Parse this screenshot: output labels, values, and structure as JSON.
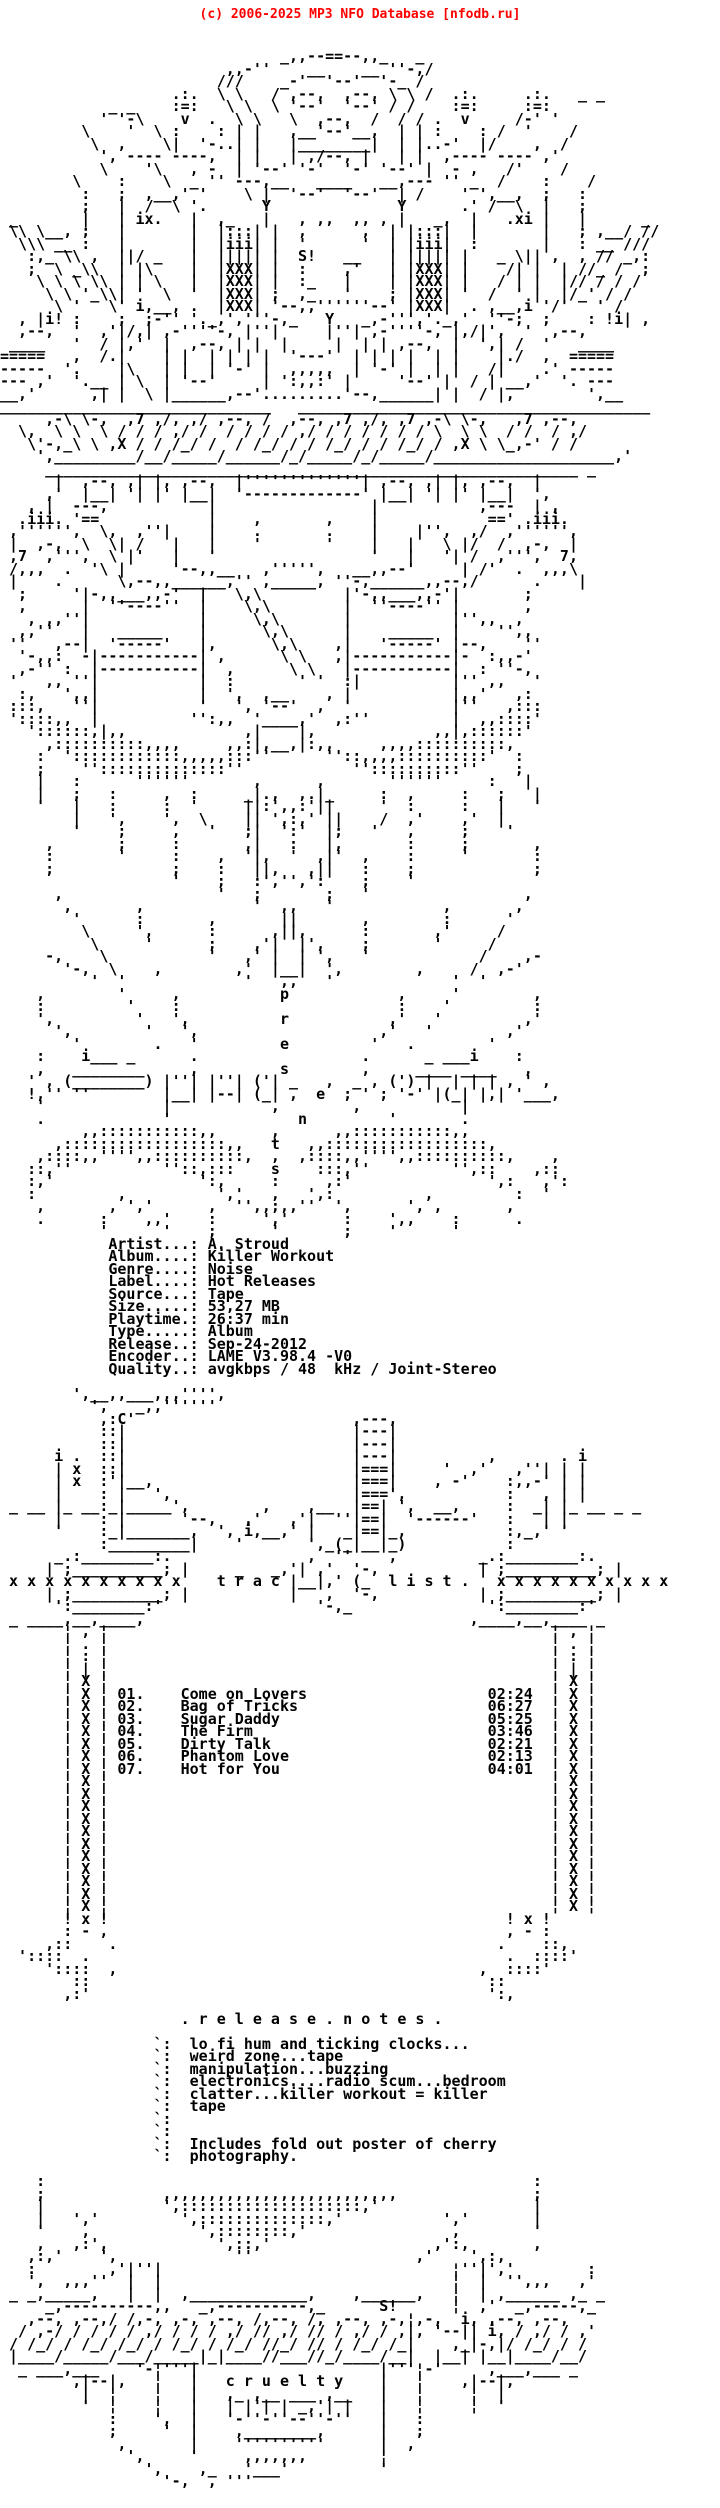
{
  "page": {
    "copyright": "(c) 2006-2025 MP3 NFO Database [nfodb.ru]"
  },
  "colors": {
    "header_text": "#ff0000",
    "body_text": "#000000",
    "background": "#ffffff"
  },
  "texts": {
    "roman_left": "ix.",
    "roman_right": ".xi",
    "shout_mark": "S!",
    "presents_vertical": "presents:",
    "proudly_word": "proudly",
    "x_row": "x x x x x x x x x x",
    "tracklist_header": "t r a c   l i s t .",
    "release_notes_header": ". r e l e a s e . n o t e s .",
    "cruelty_word": "c r u e l t y"
  },
  "release_info": {
    "fields": [
      {
        "label": "Artist...:",
        "value": "A. Stroud"
      },
      {
        "label": "Album....:",
        "value": "Killer Workout"
      },
      {
        "label": "Genre....:",
        "value": "Noise"
      },
      {
        "label": "Label....:",
        "value": "Hot Releases"
      },
      {
        "label": "Source...:",
        "value": "Tape"
      },
      {
        "label": "Size.....:",
        "value": "53,27 MB"
      },
      {
        "label": "Playtime.:",
        "value": "26:37 min"
      },
      {
        "label": "Type.....:",
        "value": "Album"
      },
      {
        "label": "Release..:",
        "value": "Sep-24-2012"
      },
      {
        "label": "Encoder..:",
        "value": "LAME V3.98.4 -V0"
      },
      {
        "label": "Quality..:",
        "value": "avgkbps / 48  kHz / Joint-Stereo"
      }
    ]
  },
  "tracklist": {
    "title": "t r a c   l i s t .",
    "tracks": [
      {
        "num": "01.",
        "title": "Come on Lovers",
        "time": "02:24"
      },
      {
        "num": "02.",
        "title": "Bag of Tricks",
        "time": "06:27"
      },
      {
        "num": "03.",
        "title": "Sugar Daddy",
        "time": "05:25"
      },
      {
        "num": "04.",
        "title": "The Firm",
        "time": "03:46"
      },
      {
        "num": "05.",
        "title": "Dirty Talk",
        "time": "02:21"
      },
      {
        "num": "06.",
        "title": "Phantom Love",
        "time": "02:13"
      },
      {
        "num": "07.",
        "title": "Hot for You",
        "time": "04:01"
      }
    ]
  },
  "release_notes": {
    "title": ". r e l e a s e . n o t e s .",
    "lines": [
      "lo fi hum and ticking clocks...",
      "weird zone...tape",
      "manipulation...buzzing",
      "electronics....radio scum...bedroom",
      "clatter...killer workout = killer",
      "tape",
      "",
      "",
      "Includes fold out poster of cherry",
      "photography."
    ]
  },
  "ascii_art": {
    "top": [
      "                               _,,--==--,,_   _",
      "                         ,,-''    __    __ ''-,/",
      "                        ///    _-'  '--'  '-_ /",
      "                   .:.  \\ \\   / ,--,  ,--, \\ \\ /  .:.     .:.   _ _",
      "            _ _    :=:   \\ \\  \\ '--'  '--' / /    :=:     :=:",
      "           ' '-\\    v  .  \\ \\   \\  ,--,  /  / / .  v     /-' '",
      "         \\    '  \\ :    : | |   ,__'--'__,  | | :    : /  '    /",
      "          \\  ,    \\|  '-..| |   |________|  | |..-'  |/    ,  /",
      "           ', ---- ----,  | |   | ,/--, |   | |  ,---- ---- ,'",
      "           \\    '\\   , -  | '--' '-'  '-' '--' |  - ,   /'    /",
      "        \\    :    \\  _ '' ---,__   ____   __,--- '' _  /    :    /",
      "         :   ;  ,__,' '    \\ |  '--'  '--'  | /    ' ',__,  ;   :",
      "         ;   |  /  \\ '.      Y              Y      .' /  \\  |   ;",
      " _       |   | ix.   |  ,_   |   , ,,  ,, , |   _,  |   .xi |   |      _",
      " \\\\ \\__, ;   |       |  |:::| |  ,      ,  | |:::|  |       |   ; ,__/ //",
      "  \\\\\\ __ :   |       |  |iii| |  '      '  | |iii|  :       |   : __ ///",
      "   :,_ \\\\ ,  ||/ _   |  ||||| |  S!   __   | ||||| |   _ \\|| ,  , // _,:",
      "   ;  \\ _\\\\  | |\\    |  |XXX| |  :    ,'   | |XXX| |    /| |  | //_ /  ;",
      "    \\ \\ \\ \\\\ | | \\   |  |XXX| |  :_   |    | |XXX| |   / | |  |// / / /",
      "     \\ \\ '_\\\\| '  \\  '  |XXX| ;  ,_   '    ; |XXX| '  /  ' |  |/_' / /",
      "      \\ '   \\' i,__, .  |XXX| '--,,''''''--' |XXX|  . ,__,i '/'   ' /",
      "  , |i! :    ;  ;-'' '._,','''-,_   Y   _,-''','._,'  ''-;  ;    : !i| ,",
      "  ,--,  '  ,'|/,| ,-''''-, |''|     |''| ,-''''-, |,/|',  '  ,--,",
      " ____   '  / |,'  |  ,--, | |  |     |  | | ,--,  |  ',| /  '   ____",
      "=====   ,  /.|    | |  | | | |  '---'  | | | |  | |    |./  ,  =====",
      "-----  '.    |\\   | |  | '-' |  ,,,,,  | '-' |  | |   /|    .' -----",
      "--- ,'  '.__ | \\  | '--'     | ':,,:' |     '--' |  / | __,'  '. ---",
      "__,'      ,| |  \\ |______,--'.........'--,______| |  / |,        ',__",
      "______________________________   _______________________________________",
      "     ,-\\ \\-,  ,7 ,/, ,/ ,--, /  ,--, ,7 ,/, ,7 ,-\\ \\-,   ,7 ,--,",
      "  \\,  \\ \\  \\ / / / ,/ /  / / / / ,/ / / / / / / \\  \\ \\  / /  / ,/",
      "   \\'-,_\\ \\ ,X / / /_/ /  / /_/ / / /_/ / / /_/ / ,X \\ \\_,-' / /",
      "    ',_________/__/_____/______/_/_____/_/_____/____________________,'",
      "     ___________________________________________________________ _",
      "      |  ,--, ,| |, ,--,  |'''''''''''''| ,--, ,| |, ,--,  |",
      "     ,'  |__| '| |' |__|  '-------------' |__| '| |' |__|  ',",
      "   , |  ---,           |                 |           ,---  | ,",
      "  .iii. '==            |    ,       ,    |            ==' .iii.",
      " ,'''''',  \\,  ,''|    |    .       .    |    |'',  ,/  ,'''''',",
      " |  ,-,  \\  \\| /   |   |    '       '    |   |   \\ |/  /  ,-,  |",
      " ,7  ,''',  \\ |'   |   '                 '   |   '| /  ,''',  7,",
      " /,,,  .  '\\ |     '--,,__   ,''''',   __,,--'     | /'  .  ,,,\\",
      " |    .      \\,--,,______,'' ,_____, ''-,______,,--,/      .    |",
      "  ;     '|-,,___,,-'  |   \\,\\         |'-,,___,,-'|       ;",
      "  ,      |  ''----''  |    \\,\\        |  ''----'' |       ,",
      "   , ,,''|            |     \\,\\       |           |'',,  ,",
      "  ,,''   |   _____    |      \\,\\      |    _____  |    '',,",
      " ''   ,--|  '-----'   |,      \\,\\    ,|   '-----' |--,    ''",
      "  '-,,:  -|-----------| ,      \\ \\   ,|-----------|-  :,,-'",
      "  ,-'' :  |-----------|  ,      \\ \\   |-----------|  : ''-,",
      " '   ,, ''|           |  :       ' '  :|          |'' ,,   '",
      "  :,   ',,|           |  ',  ,__    , |           |,,'   ,:",
      " :::,   ''|           '   ', '--'  ,  '           |''   ,:::",
      " '::::,,  |          '':,,  '____,'  ,:''         |  ,,::::'",
      "   '::::::,|,,             ,|    |,             ,,|,::::::'",
      "     ,::::::::::,,,,     ,,:|,__,|:,,     ,,,,::::::::::,",
      "    :  '::::::::::::,,,,,:::''      ''::,,,,::::::::::'  :",
      "    ;    ''::::::::::::::''            ''::::::::::''    ;",
      "    |   :      ''''''       ,      ,       ''''''     :   |",
      "    |   ;   :     ,  :     _|.,  ,.|_     :  ,     :   ;   |",
      "    '   |   :     :  '     ||:',,:'||     '  :     :   |   '",
      "        |   ',    ',  \\    || ',:,' ||    /  ,'    ,'  |",
      "        '    ;     ,   '   ;|  ':'  |;   '   ,     ;    '",
      "     ,       ;     :       ,|   :   |,       :     ;       ,",
      "     :       '     :    ,  '|,  '  ,|'  ,    :     '       :",
      "     ;             ;    :   ||,   ,||   :    ;             ;",
      "                   '    ;   :','',':    ;    '",
      "      ,                 '   ;       ;   '                 ,",
      "       ,       ,            '  ,,   '            ,       ,",
      "        '      :       ,       ||       ,        :      '",
      "         \\     ',      :      ,||,      :       ,'     /",
      "          \\     '      ;    ,'|  |',    ;       '     /",
      "     -,    \\           '   ,' |  | ',   '            /    ,-",
      "       '-,  \\    ,        ,'  |__|  ',        ,     /  ,-'",
      "          '  '             '   ,,   '             '  '",
      "    ,        '     ,           p            ,     '        ,",
      "    :         '    :                        :    '         :",
      "    ',         '   ',          r           ,'   '         ,'",
      "      ',        '   ',                    ,'   '        ,'",
      "        '        .   '         e         '   .        '",
      "    :    i___ _      .                  .      _ ___i    :",
      "    ,   ________     ,         s        ,     ____ ____   ,",
      "   ' , (________) |''| |''| ('| _   ,  _ , (') |  | | | , ' ,",
      "   !,'' ''        |__| |--| (_| ,  e  ; ' ; '-' |(_| |,| '___,",
      "    '             |           ,        ,           |",
      "    .             '              n         '       .",
      "         ,,:::::::::::,,      ,      ,,:::::::::::,,",
      "      ,::::::::::::::::::,,   t   ,,::::::::::::::::::,",
      "    ,::::,,'''',,::::::::::,  ,  ,::::,,'''',,::::::::::,    ,",
      "   ::,''          ''::,:::    s    :::,''         '',::    ,::",
      "   :,'                ':,     :     ,:'               ',:   ,':",
      "   :         ,          ','   ,   ',:          ,         :  '",
      "    ,       , ','      ,  '',,;,,''  ',      ', ,       ,",
      "    .      :    ,,'    :     ','      :    ',,    :      .",
      "           '      '    ;      '       ;    '      '"
    ],
    "middle": [
      "        ',__,,___,,,'''',",
      "          ',   _,,''''''",
      "           ,:C'                        ,---,",
      "           ::|                         |---|",
      "           ::|                         |---|",
      "      i .  ::|                         |---|          ,       . i",
      "      | x  ::|                         |===|     '  ,'   ,''| | |",
      "      | x  :'|__,                      |===|    , -'    :,,-' | |",
      "      |    : |   ',                    |===',           :   , | |",
      " _ __ |_ __:_|_____',        ,    ,__  |==| ',  __,     :  _| |_ __ _ _",
      "      |    : |      '--,   ,'   ,'|  ''|==|  '------'   :   | |",
      "      '    :_|_______,  ', i,__,' |   _|==|_,           :,_,' '",
      "           :_________|    '       ',_(_|__|_)           :",
      "      _.:________:.               ,  ''    ,         _.:________:.",
      "     | ;__________; |     _   _,'| ,'  '-,           | ;__________; |",
      " x x x x x x x x x x    t r a c |__|,' (_  l i s t .   x x x x x x x x x x",
      "     | ;__________; |           |   ,  '-,           | ;__________; |",
      "      ':________:'                 '-,_               ':________:'",
      " _ ____,__,____,                                    ,____,__,____ _"
    ],
    "tail": [
      "       ! x !                                            ! x !",
      "       : - ,                                            , - :",
      "     ,::    .                                          .    ::,",
      "  '::::  .                                              .  ::::'",
      "     '::::  ,                                        ,  ::::'",
      "        ::                                            ::",
      "       ,:'                                            ':,"
    ],
    "lower": [
      "    :                                                      :",
      "    ;             ,,,,,,,,,,,,,,,,,,,,,,,,,,               ;",
      "    |             ',::::::::::::::::::::,'                 |",
      "    |   ','         ',::::::::::::::,'           ','       |",
      "    '    ,            ',::::::::,'                ,        '",
      "    ,   ,:',            ',::,'                  ,':,       ,",
      "   ,:,'    ',             ''                  ,'    ',:,"
    ],
    "bottom": [
      "   :        ,'|''|                                ¦''|','        :",
      "   ',  ,,,''  |  |                                ¦  |  '',,,   ,'",
      " _ _,_____,   |  |  ,_____________,    ,______,   ¦  | ,______ ,_ _",
      "     _,----------,,   _,----------,_      S!      ¦  ,'  _,-----,_",
      "   ,--, ,--,/ /,-, ,-, ,--, /,--, /, ,--, ,-,¦,-,  i, ,--, ,--,",
      "  / ,-/ / / / / ,/ / / / ,/ // ,/ // / ,/ / ,|, '--|| i, / ,/ / ,'",
      " / /_/ / /_/ /_/ / /_/ / /_/ //_/ // / /_/ /_|    ,_|-,|/ /_/ / /",
      " |____/_____/___/_____|_|____//___//_/____/__|  |__| |__|____/__/",
      "  _ ___,___    '-¦'''|                    |'''¦-'     ,___,___ _",
      "        ,|--|,   ¦   |   c r u e l t y    |   ¦    ,|--|,",
      "         |  ¦    ¦   |   ,_ ,__ ___ ,__   |   ¦     ¦  |",
      "         '  ¦    ¦   |   | |'| | _,'| |   |   ¦     ¦  '",
      "            :    ',  |   '-''-''--''-''   |   :",
      "            ;     '  |    ,________,      |   ;",
      "             ,       |    ''''''''''      |  ,",
      "              ',     '     ,,,,,,,        ¦",
      "                ',    ,_   '___'          '",
      "                  '-,__, '''"
    ]
  }
}
